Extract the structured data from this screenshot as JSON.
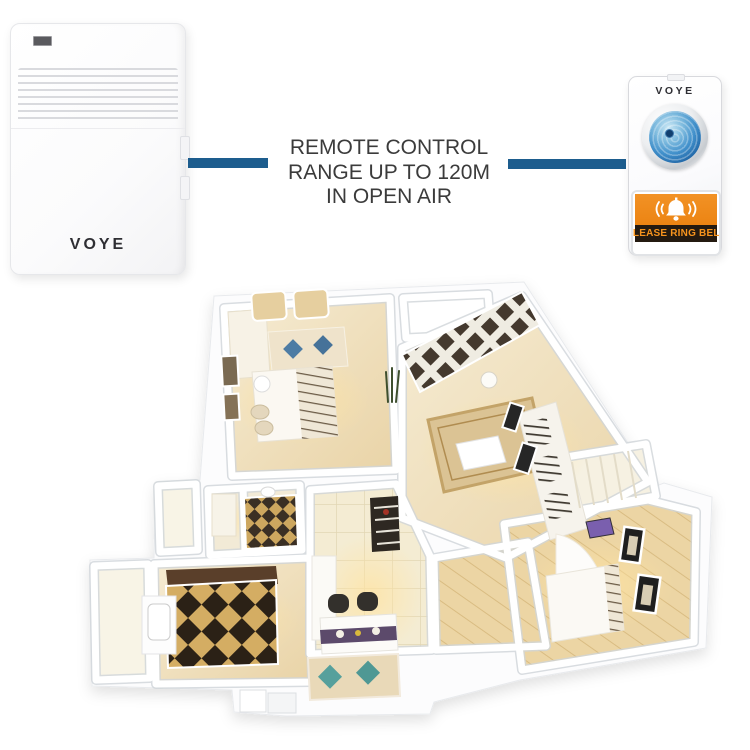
{
  "receiver": {
    "brand": "VOYE"
  },
  "caption": {
    "lines": [
      "REMOTE CONTROL",
      "RANGE UP TO 120M",
      "IN OPEN AIR"
    ]
  },
  "transmitter": {
    "brand": "VOYE",
    "plate_label": "PLEASE RING BELL"
  },
  "icons": [
    "led-indicator",
    "speaker-grille",
    "ring-button-lens",
    "bell-icon"
  ],
  "colors": {
    "connector_blue": "#1d5d8e",
    "caption_text": "#3b3b3b",
    "orange_panel": "#ee8a1e",
    "plate_text": "#f7941d",
    "plate_bg": "#241a10",
    "lens_blue": "#2268a8",
    "brand_text": "#2e2e33",
    "floor_beige": "#eeddb6",
    "checker_dark": "#2b2116",
    "checker_gold": "#d4ad63",
    "pillow_blue": "#4d7ca4",
    "pillow_teal": "#56a09c",
    "runner_purple": "#5c4a6b"
  }
}
